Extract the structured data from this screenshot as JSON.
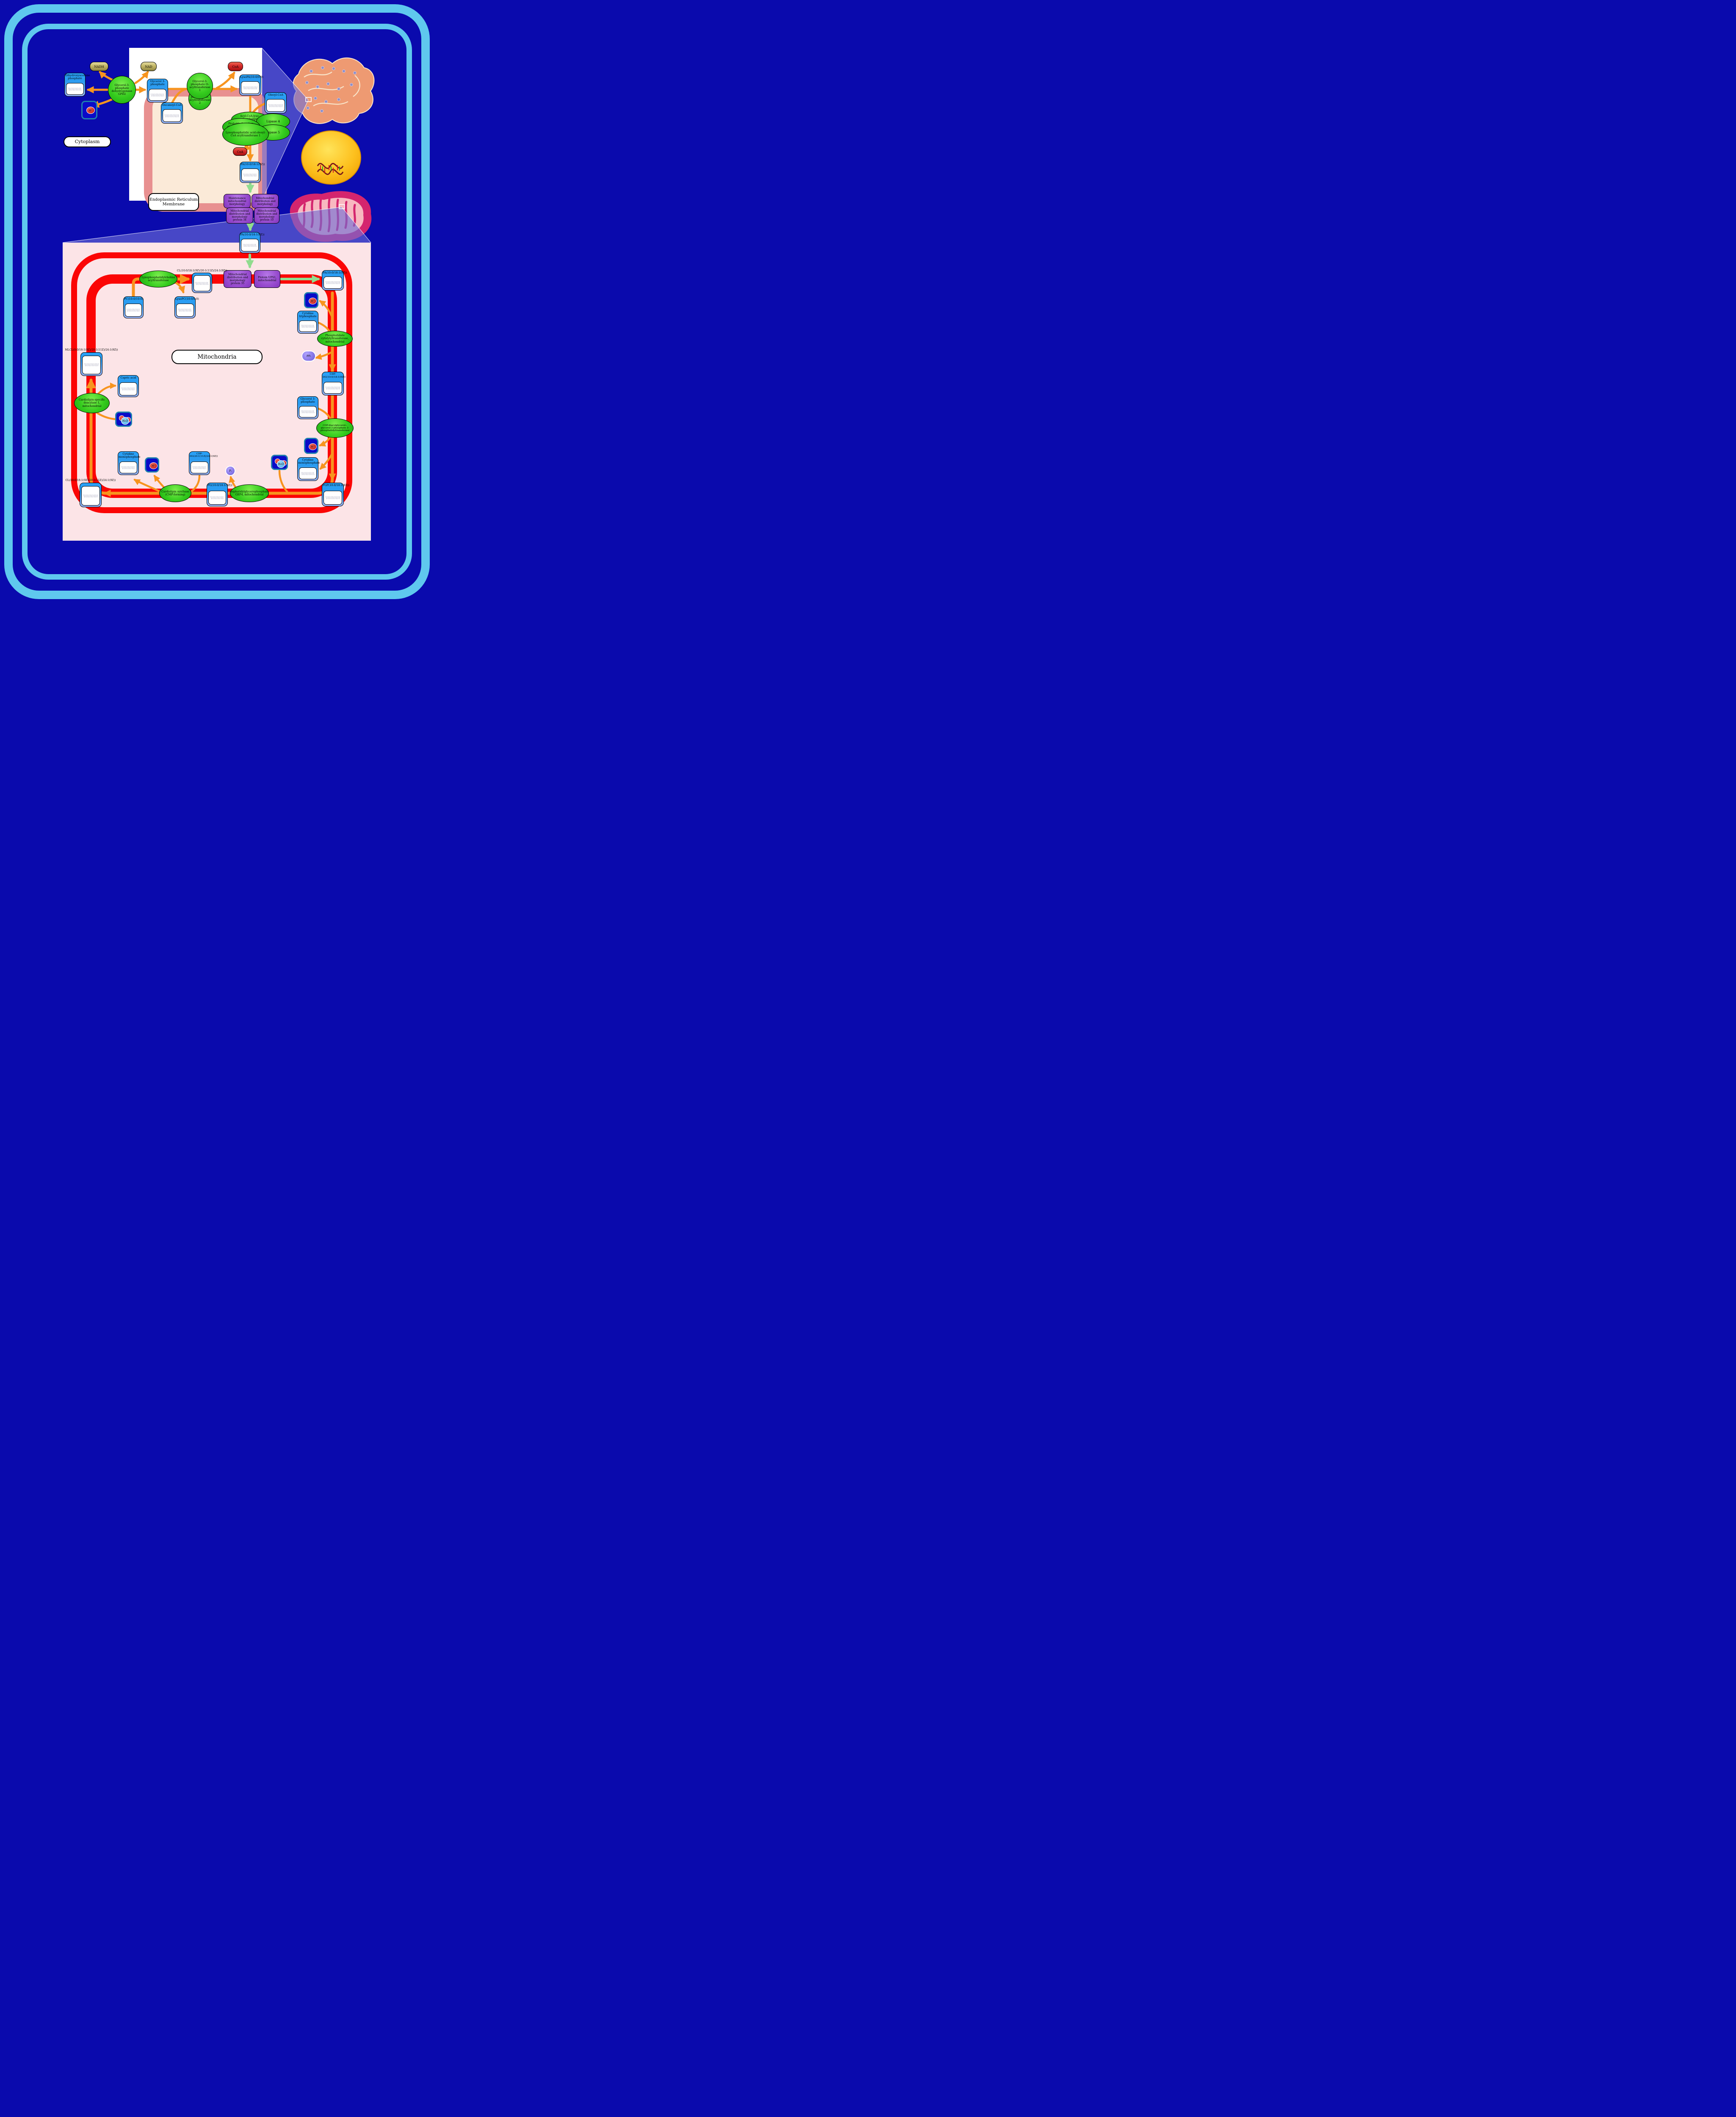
{
  "regions": {
    "cytoplasm": "Cytoplasm",
    "er_membrane": "Endoplasmic Reticulum Membrane",
    "mitochondria": "Mitochondria"
  },
  "icons": {
    "er_illustration": "endoplasmic-reticulum-illustration",
    "nucleus_illustration": "nucleus-with-dna-illustration",
    "mitochondrion_illustration": "mitochondrion-illustration",
    "zoom_marker": "zoom-region-marker",
    "molecule": "chemical-structure-drawing"
  },
  "colors": {
    "background": "#0a0aad",
    "cell_membrane": "#5fc8ee",
    "er_band": "#e89090",
    "er_lumen": "#fbead8",
    "mito_fill": "#fce4e7",
    "mito_membrane": "#fb0505",
    "arrow_orange": "#f7941e",
    "arrow_green": "#90dc8e",
    "metabolite_blue": "#2b9bf0",
    "enzyme_green": "#35cc1e",
    "protein_purple": "#9a4fd0",
    "cofactor_gold": "#c3b766",
    "cofactor_red": "#d42a2a",
    "ion_box_blue": "#0a0ac8"
  },
  "metabolites": {
    "dhap": "Dihydroxyacetone phosphate",
    "g3p": "Glycerol 3-phosphate",
    "lysopa": "LysoPA(10:0/0:0)",
    "oleoyl_coa": "Oleoyl-CoA",
    "decanoyl_coa": "Decanoyl-CoA",
    "pa": "PA(10:0/18:1(9Z))",
    "cl": "CL(10:0/18:1(9Z)/20:1(11Z)/24:1(9Z))",
    "mlcl": "MLCL(0:0/18:1(9Z)/20:1(11Z)/24:1(9Z))",
    "pc": "PC(10:0/10:0)",
    "lysopc": "LysoPC(10:0/0:0)",
    "capric_acid": "Capric acid",
    "ctp": "Cytidine triphosphate",
    "cmp": "Cytidine monophosphate",
    "cdp_dg_1": "CDP-DG(10:0/18:1(9Z))",
    "cdp_dg_2": "CDP-DG(20:1(11Z)/24:1(9Z))",
    "pgp": "PGP(10:0/18:1(9Z))",
    "pg": "PG(10:0/18:1(9Z))"
  },
  "cofactors": {
    "nadh": "NADH",
    "nad": "NAD",
    "coa": "CoA",
    "h_plus": "H⁺",
    "h2o": "H₂O",
    "ppi": "PPᵢ",
    "pi": "Pᵢ"
  },
  "enzymes": {
    "gpd2": "Glycerol-3-phosphate dehydrogenase GPD2",
    "gpat1": "Glycerol-3-phosphate O-acyltransferase 1",
    "gpat2": "Glycerol-3-phosphate O-acyltransferase 2",
    "acyl_lyso": "Acyl-CoA:lyso-phospholipid acyltransferase",
    "probable_agpat": "Probable 1-acyl-sn-glycerol-3-phosphate acyltransferase",
    "lipase4": "Lipase 4",
    "lipase5": "Lipase 5",
    "lpaat1": "Lysophosphatidic acid:oleoyl-CoA acyltransferase 1",
    "lpcat": "Lysophosphatidylcholine acyltransferase",
    "pct_mito": "Phosphatidate cytidylyltransferase, mitochondrial",
    "pgs1": "CDP-diacylglycerol--glycerol-3-phosphate 3-phosphatidyltransferase",
    "gep4": "Phosphatidylglycerophosphatase GEP4, mitochondrial",
    "cls": "Cardiolipin synthase (CMP-forming)",
    "cld1": "Cardiolipin-specific deacylase 1, mitochondrial"
  },
  "proteins": {
    "mmm": "Maintenance mitochondrial morphology",
    "mdm": "Mitochondrial distribution and morphology",
    "mdm34": "Mitochondrial distribution and morphology protein 34",
    "mdm10": "Mitochondrial distribution and morphology protein 10",
    "mdm35": "Mitochondrial distribution and morphology protein 35",
    "ups1": "Protein UPS1, mitochondrial"
  }
}
